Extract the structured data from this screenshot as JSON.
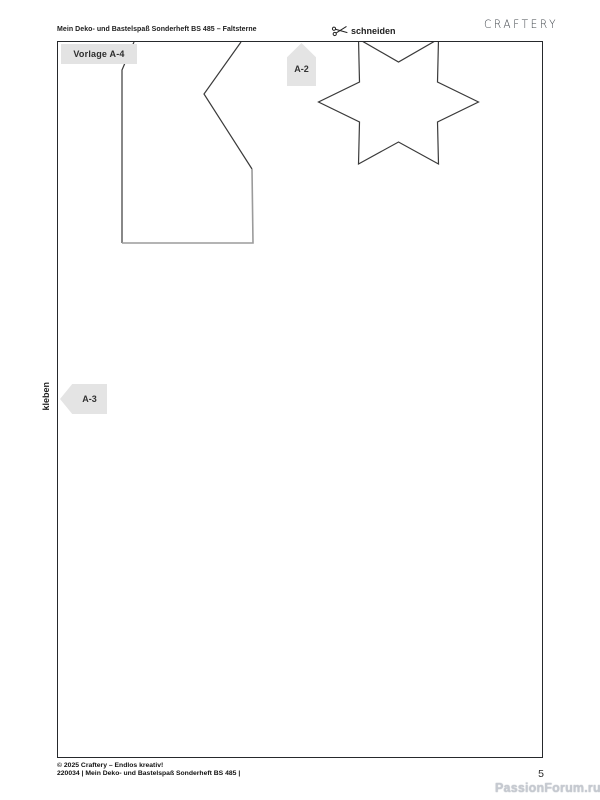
{
  "header": {
    "title": "Mein Deko- und Bastelspaß Sonderheft BS 485 – Faltsterne",
    "brand": "CRAFTERY"
  },
  "labels": {
    "template": "Vorlage A-4",
    "cut": "schneiden",
    "glue": "kleben",
    "arrow_up": "A-2",
    "arrow_left": "A-3"
  },
  "shapes": {
    "left_outline_left": "76,0 64,28 64,201",
    "left_outline_right": "183,0 146,52 194,127",
    "left_outline_fold": "64,201 195,201 194,127",
    "star": "420.5,60 379.5,40 380.5,-3 340.5,20 300.5,-3 301.5,40 260.5,60 301.5,80 300.5,122 340.5,100 380.5,122 379.5,80"
  },
  "footer": {
    "copyright": "© 2025 Craftery – Endlos kreativ!",
    "issue": "220034 | Mein Deko- und Bastelspaß Sonderheft BS 485 |",
    "page": "5"
  },
  "watermark": "PassionForum.ru",
  "colors": {
    "line_dark": "#3a3a3a",
    "line_fold": "#9b9b9b",
    "box_gray": "#e3e3e3",
    "border": "#26292c"
  }
}
